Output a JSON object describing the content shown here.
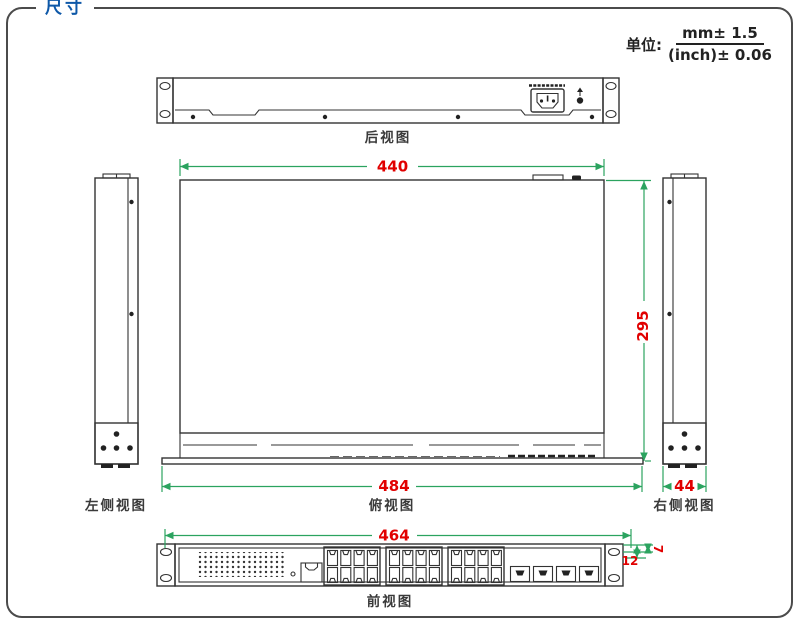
{
  "page": {
    "title": "尺寸",
    "unit": {
      "label": "单位:",
      "numerator": "mm± 1.5",
      "denominator": "(inch)± 0.06"
    }
  },
  "views": {
    "rear": "后视图",
    "left_side": "左侧视图",
    "top": "俯视图",
    "right_side": "右侧视图",
    "front": "前视图"
  },
  "dims": {
    "body_width": "440",
    "body_depth": "295",
    "overall_width": "484",
    "side_width": "44",
    "front_width": "464",
    "ear_offset_a": "7",
    "ear_offset_b": "12"
  },
  "colors": {
    "dimension_line": "#2ba35f",
    "dimension_text": "#e10000",
    "title_blue": "#0e58a8",
    "drawing_line": "#333333"
  }
}
